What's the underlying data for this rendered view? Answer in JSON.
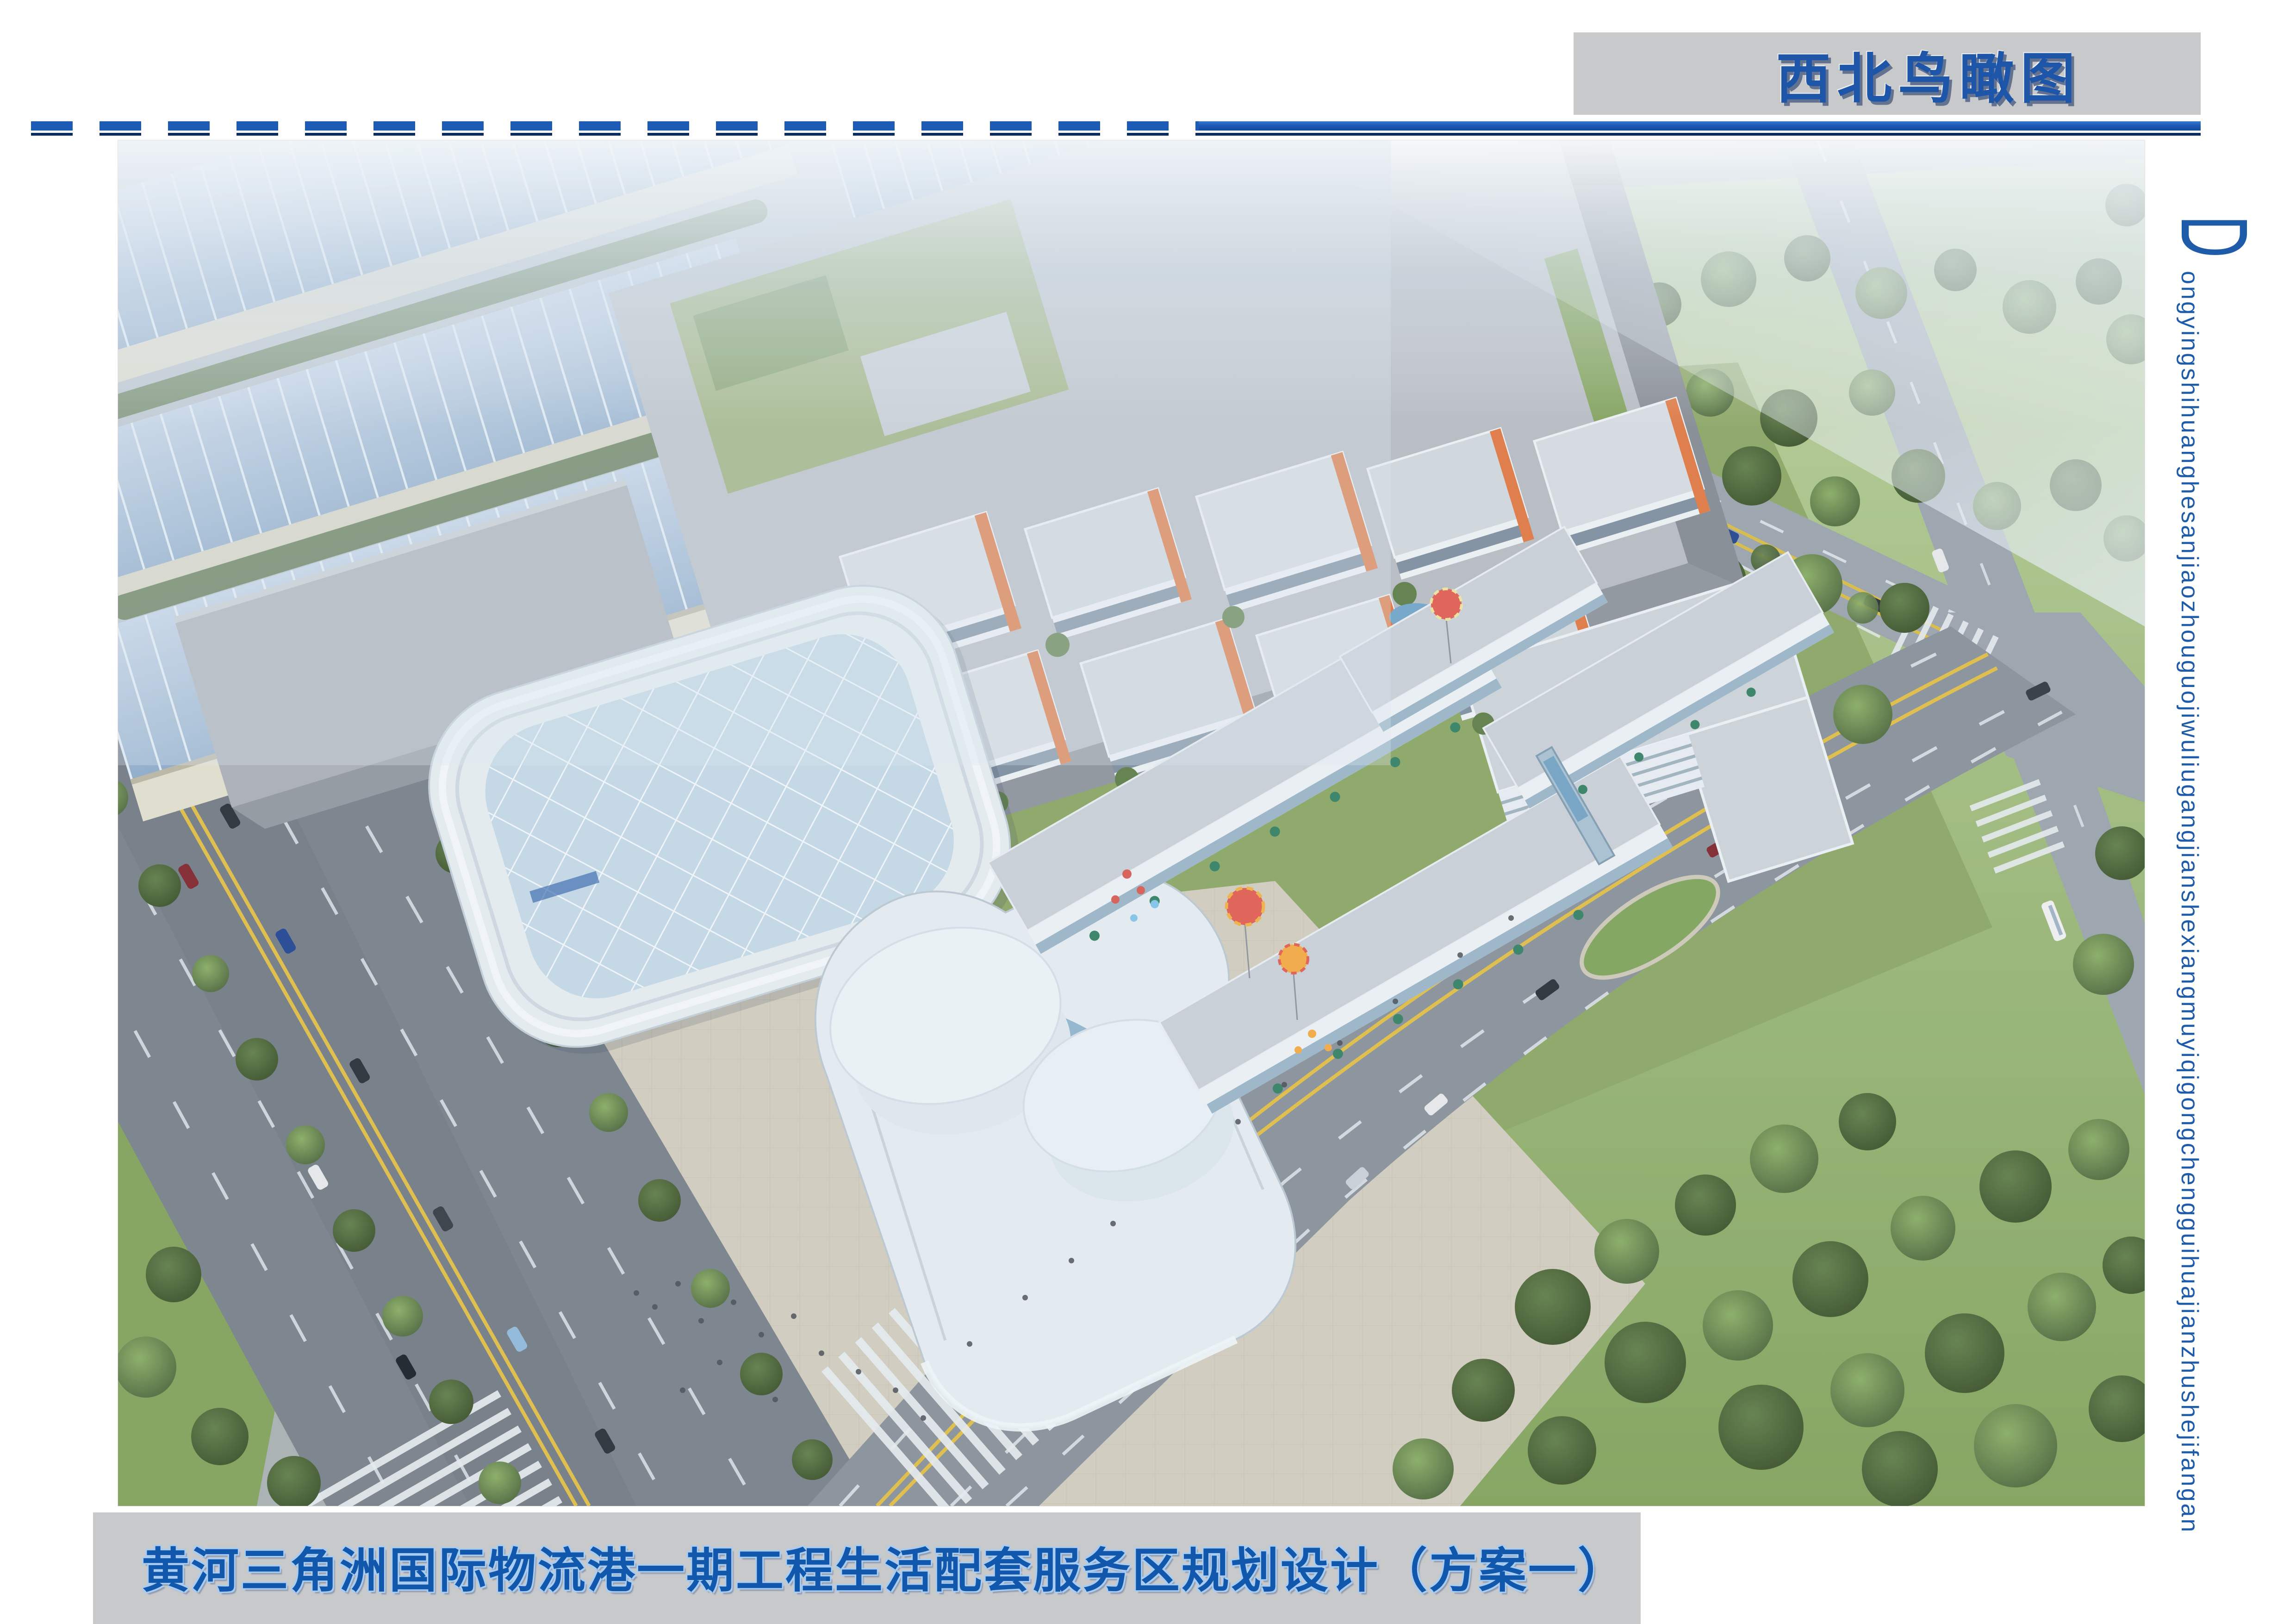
{
  "header": {
    "title": "西北鸟瞰图",
    "accent_color": "#1d5bb5",
    "box_color": "#c8c9cb"
  },
  "footer": {
    "title": "黄河三角洲国际物流港一期工程生活配套服务区规划设计（方案一）",
    "text_color": "#1157ac"
  },
  "side_label": {
    "initial": "D",
    "pinyin": "ongyingshihuanghesanjiaozhouguojiwuliugangjianshexiangmuyiqigongchengguihuajianzhushejifangan"
  },
  "rendering": {
    "alt": "西北鸟瞰图：物流港生活配套服务区整体鸟瞰效果图",
    "palette": {
      "warehouse_roof_blue": "#9db6d4",
      "big_box_gray": "#b3b8bf",
      "campus_roof": "#d6dbe0",
      "accent_orange": "#e0743c",
      "lawn_green": "#8aa45f",
      "forest_green": "#4c6b38",
      "asphalt": "#81889297",
      "marking_yellow": "#e0bc3e",
      "plaza_tan": "#d2cbbb"
    }
  }
}
